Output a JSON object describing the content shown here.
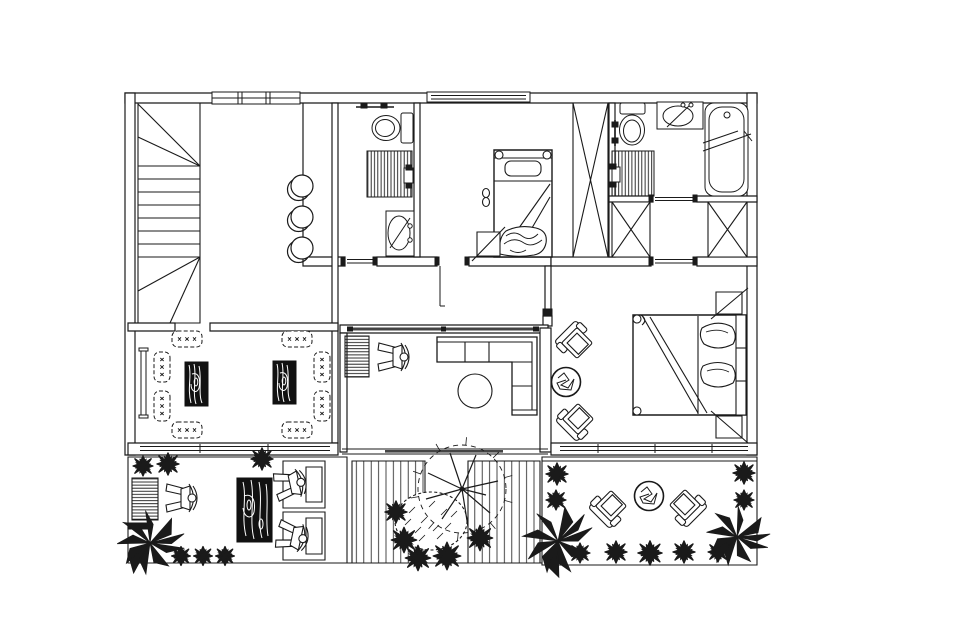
{
  "document": {
    "kind": "architectural floor plan",
    "style": "black-and-white CAD line drawing, top-down view",
    "ink_color": "#1a1a1a",
    "background_color": "#ffffff",
    "slider_door_color": "#444444"
  },
  "plan": {
    "rooms": [
      {
        "id": "staircase",
        "label": "winder staircase with straight treads"
      },
      {
        "id": "hallway",
        "label": "hallway with three round stools along partition"
      },
      {
        "id": "bathroom-1",
        "label": "bathroom with toilet, shower cabin, pedestal sink, towel bar"
      },
      {
        "id": "bedroom-1",
        "label": "bedroom with single bed, pillow, folded blanket, bedside stool, slippers, tall wardrobe"
      },
      {
        "id": "bathroom-2",
        "label": "master bathroom with toilet, vanity sink, bathtub, shower cabin"
      },
      {
        "id": "dressing-area",
        "label": "dressing nook flanked by two wardrobes"
      },
      {
        "id": "master-bedroom",
        "label": "master bedroom with double bed, two nightstands, two lounge chairs, round side table"
      },
      {
        "id": "living-room",
        "label": "living pavilion with TV cabinet, armchair, L-shaped sofa, round coffee table, sliding glass door"
      },
      {
        "id": "floor-lounge",
        "label": "floor-seating lounge with two wood-grain tables, eight floor cushions, wall console"
      },
      {
        "id": "terrace-left",
        "label": "terrace with TV cabinet, armchair, wood-grain table, two deck chairs on rugs, shrubs, leafy plant"
      },
      {
        "id": "courtyard-garden",
        "label": "courtyard with two plank decks, large tree, hedge bush, dark shrubs"
      },
      {
        "id": "terrace-right",
        "label": "terrace with two diagonal armchairs, round scribble table, shrubs, leafy plants"
      }
    ],
    "fixtures": [
      "toilet",
      "shower",
      "pedestal-sink",
      "vanity-sink",
      "bathtub",
      "towel-bar"
    ],
    "furniture": [
      "single-bed",
      "double-bed",
      "wardrobe",
      "nightstand",
      "l-shaped-sofa",
      "armchair",
      "coffee-table",
      "side-table",
      "floor-cushion",
      "wood-table",
      "tv-cabinet",
      "console",
      "stool"
    ],
    "outdoor_elements": [
      "deck-planks",
      "tree",
      "bush",
      "shrub",
      "leafy-plant"
    ],
    "counts": {
      "floor_cushions": 8,
      "wardrobes_x_symbol": 3,
      "round_stools": 3,
      "windows_top_wall": 2,
      "shrubs_total": 21,
      "decks": 2
    }
  }
}
